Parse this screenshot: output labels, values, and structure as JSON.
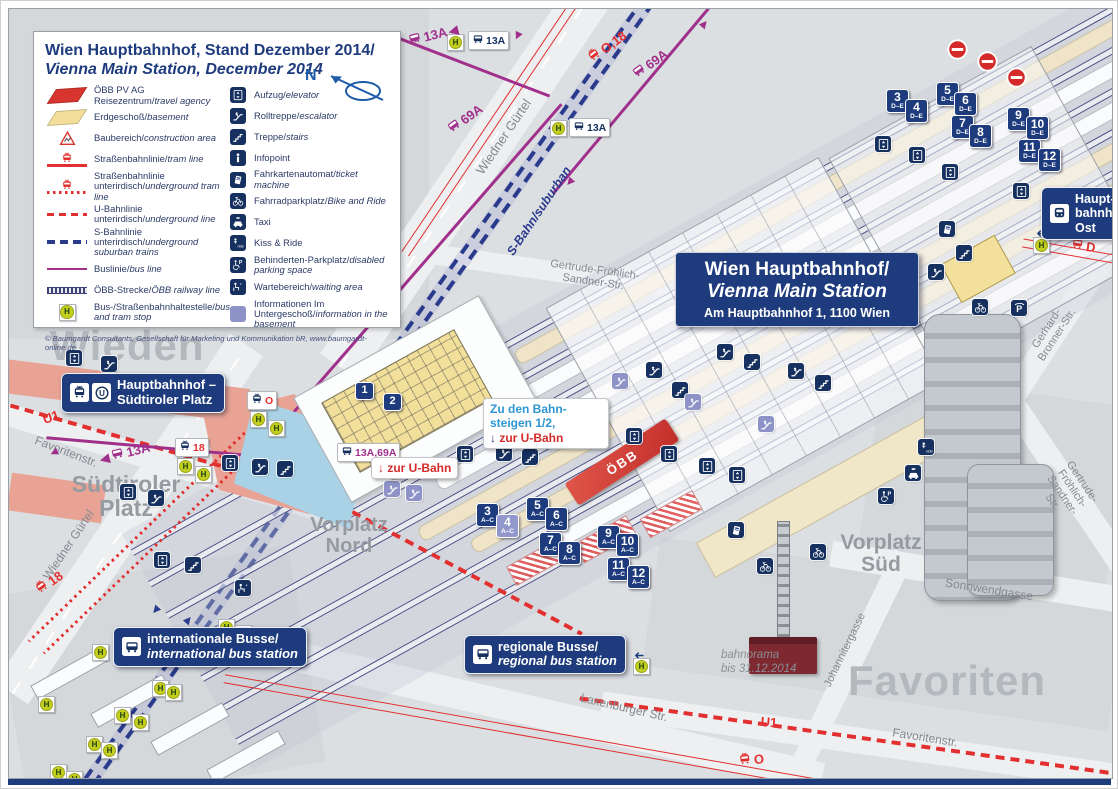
{
  "legend": {
    "title_de": "Wien Hauptbahnhof, Stand Dezember 2014/",
    "title_en": "Vienna Main Station, December 2014",
    "copyright": "© Baumgardt Consultants, Gesellschaft für Marketing und Kommunikation bR, www.baumgardt-online.de",
    "north_label": "N",
    "left_items": [
      {
        "icon": "sw-red",
        "de": "ÖBB PV AG Reisezentrum/",
        "en": "travel agency"
      },
      {
        "icon": "sw-yellow",
        "de": "Erdgeschoß/",
        "en": "basement"
      },
      {
        "icon": "construction",
        "de": "Baubereich/",
        "en": "construction area"
      },
      {
        "icon": "line-tram",
        "de": "Straßenbahnlinie/",
        "en": "tram line"
      },
      {
        "icon": "line-tram-ug",
        "de": "Straßenbahnlinie unterirdisch/",
        "en": "underground tram line"
      },
      {
        "icon": "line-u",
        "de": "U-Bahnlinie unterirdisch/",
        "en": "underground line"
      },
      {
        "icon": "line-s",
        "de": "S-Bahnlinie unterirdisch/",
        "en": "underground suburban trains"
      },
      {
        "icon": "line-bus",
        "de": "Buslinie/",
        "en": "bus line"
      },
      {
        "icon": "line-rail",
        "de": "ÖBB-Strecke/",
        "en": "ÖBB railway line"
      },
      {
        "icon": "hstop",
        "de": "Bus-/Straßenbahnhaltestelle/",
        "en": "bus and tram stop"
      }
    ],
    "right_items": [
      {
        "icon": "elevator",
        "de": "Aufzug/",
        "en": "elevator"
      },
      {
        "icon": "escalator",
        "de": "Rolltreppe/",
        "en": "escalator"
      },
      {
        "icon": "stairs",
        "de": "Treppe/",
        "en": "stairs"
      },
      {
        "icon": "info",
        "de": "Infopoint",
        "en": ""
      },
      {
        "icon": "ticket",
        "de": "Fahrkartenautomat/",
        "en": "ticket machine"
      },
      {
        "icon": "bike",
        "de": "Fahrradparkplatz/",
        "en": "Bike and Ride"
      },
      {
        "icon": "taxi",
        "de": "Taxi",
        "en": ""
      },
      {
        "icon": "kissride",
        "de": "Kiss & Ride",
        "en": ""
      },
      {
        "icon": "disabled",
        "de": "Behinderten-Parkplatz/",
        "en": "disabled parking space"
      },
      {
        "icon": "waiting",
        "de": "Wartebereich/",
        "en": "waiting area"
      },
      {
        "icon": "basement",
        "de": "Informationen Im Untergeschoß/",
        "en": "information in the basement"
      }
    ]
  },
  "title_box": {
    "line1": "Wien Hauptbahnhof/",
    "line2": "Vienna Main Station",
    "line3": "Am Hauptbahnhof 1, 1100 Wien"
  },
  "badges": {
    "hbf_suedtiroler": {
      "line1": "Hauptbahnhof –",
      "line2": "Südtiroler Platz"
    },
    "hbf_ost": {
      "line1": "Haupt-",
      "line2": "bahnhof",
      "line3": "Ost"
    },
    "int_bus": {
      "line1": "internationale Busse/",
      "line2": "international bus station"
    },
    "reg_bus": {
      "line1": "regionale Busse/",
      "line2": "regional bus station"
    }
  },
  "info_boxes": {
    "platforms": {
      "line1": "Zu den Bahn-",
      "line2": "steigen 1/2,",
      "arrow": "↓",
      "line3": "zur U-Bahn"
    },
    "ubahn": {
      "arrow": "↓",
      "text": "zur U-Bahn"
    }
  },
  "oebb_band_label": "ÖBB",
  "bahnorama": {
    "line1": "bahnorama",
    "line2": "bis 31.12.2014"
  },
  "icon_letters": {
    "ubahn": "U",
    "hstop": "H",
    "parking": "P"
  },
  "districts": [
    {
      "text": "Wieden",
      "x": 118,
      "y": 337,
      "size": 42
    },
    {
      "text": "Favoriten",
      "x": 938,
      "y": 672,
      "size": 42
    }
  ],
  "places": [
    {
      "lines": [
        "Südtiroler",
        "Platz"
      ],
      "x": 117,
      "y": 487,
      "size": 23
    },
    {
      "lines": [
        "Vorplatz",
        "Nord"
      ],
      "x": 340,
      "y": 527,
      "size": 20
    },
    {
      "lines": [
        "Vorplatz",
        "Süd"
      ],
      "x": 872,
      "y": 545,
      "size": 21
    }
  ],
  "streets": [
    {
      "text": "Wiedner Gürtel",
      "x": 495,
      "y": 128,
      "rot": -56,
      "size": 13
    },
    {
      "text": "Wiedner Gürtel",
      "x": 60,
      "y": 536,
      "rot": -56,
      "size": 12
    },
    {
      "text": "Favoritenstr.",
      "x": 57,
      "y": 443,
      "rot": 21,
      "size": 12
    },
    {
      "text": "Favoritenstr.",
      "x": 916,
      "y": 729,
      "rot": 9,
      "size": 12
    },
    {
      "text": "Gertrude-Fröhlich-\nSandner-Str.",
      "x": 585,
      "y": 267,
      "rot": 8,
      "size": 11
    },
    {
      "text": "Gertrude-Fröhlich-Sandner-Str.",
      "x": 1058,
      "y": 483,
      "rot": 56,
      "size": 11
    },
    {
      "text": "Gerhard-Bronner-Str.",
      "x": 1043,
      "y": 323,
      "rot": -57,
      "size": 11
    },
    {
      "text": "Sonnwendgasse",
      "x": 980,
      "y": 581,
      "rot": 9,
      "size": 12
    },
    {
      "text": "Johannitergasse",
      "x": 836,
      "y": 641,
      "rot": -64,
      "size": 11
    },
    {
      "text": "Laxenburger Str.",
      "x": 615,
      "y": 699,
      "rot": 13,
      "size": 12
    }
  ],
  "line_labels": [
    {
      "text": "13A",
      "x": 424,
      "y": 26,
      "rot": -14,
      "color": "#a0308c",
      "icon": "bus",
      "arrow": "trail"
    },
    {
      "text": "O,18",
      "x": 598,
      "y": 38,
      "rot": -36,
      "color": "#e23030",
      "icon": "tram"
    },
    {
      "text": "69A",
      "x": 641,
      "y": 55,
      "rot": -36,
      "color": "#a0308c",
      "icon": "bus"
    },
    {
      "text": "69A",
      "x": 456,
      "y": 110,
      "rot": -36,
      "color": "#a0308c",
      "icon": "bus"
    },
    {
      "text": "13A",
      "x": 116,
      "y": 444,
      "rot": -14,
      "color": "#a0308c",
      "icon": "bus",
      "arrow": "lead"
    },
    {
      "text": "U1",
      "x": 42,
      "y": 408,
      "rot": -20,
      "color": "#e23030"
    },
    {
      "text": "18",
      "x": 40,
      "y": 574,
      "rot": -36,
      "color": "#e23030",
      "icon": "tram"
    },
    {
      "text": "S-Bahn/suburban",
      "x": 530,
      "y": 202,
      "rot": -56,
      "color": "#2a3a8c",
      "italic": true,
      "size": 12.5
    },
    {
      "text": "D",
      "x": 1074,
      "y": 237,
      "rot": 8,
      "color": "#e23030",
      "icon": "tram"
    },
    {
      "text": "U1",
      "x": 760,
      "y": 713,
      "rot": 5,
      "color": "#e23030"
    },
    {
      "text": "O",
      "x": 742,
      "y": 751,
      "rot": -6,
      "color": "#e23030",
      "icon": "tram"
    }
  ],
  "stop_badges": [
    {
      "icon": "bus",
      "text": "13A",
      "x": 459,
      "y": 22,
      "color": "#16315f"
    },
    {
      "icon": "bus",
      "text": "13A",
      "x": 560,
      "y": 109,
      "color": "#16315f"
    },
    {
      "icon": "bus",
      "text": "13A,69A",
      "x": 328,
      "y": 434,
      "color": "#a0308c"
    },
    {
      "icon": "tram",
      "text": "18",
      "x": 166,
      "y": 429,
      "color": "#e23030"
    },
    {
      "icon": "tram",
      "text": "O",
      "x": 238,
      "y": 382,
      "color": "#e23030"
    }
  ],
  "platform_badges": [
    {
      "n": "1",
      "x": 346,
      "y": 373,
      "plain": true
    },
    {
      "n": "2",
      "x": 374,
      "y": 384,
      "plain": true
    },
    {
      "n": "3",
      "l": "A–C",
      "x": 467,
      "y": 494
    },
    {
      "n": "4",
      "l": "A–C",
      "x": 487,
      "y": 505,
      "light": true
    },
    {
      "n": "5",
      "l": "A–C",
      "x": 517,
      "y": 488
    },
    {
      "n": "6",
      "l": "A–C",
      "x": 536,
      "y": 498
    },
    {
      "n": "7",
      "l": "A–C",
      "x": 530,
      "y": 523
    },
    {
      "n": "8",
      "l": "A–C",
      "x": 549,
      "y": 532
    },
    {
      "n": "9",
      "l": "A–C",
      "x": 588,
      "y": 516
    },
    {
      "n": "10",
      "l": "A–C",
      "x": 607,
      "y": 524
    },
    {
      "n": "11",
      "l": "A–C",
      "x": 598,
      "y": 548
    },
    {
      "n": "12",
      "l": "A–C",
      "x": 618,
      "y": 556
    },
    {
      "n": "3",
      "l": "D–E",
      "x": 877,
      "y": 80
    },
    {
      "n": "4",
      "l": "D–E",
      "x": 896,
      "y": 90
    },
    {
      "n": "5",
      "l": "D–E",
      "x": 927,
      "y": 73
    },
    {
      "n": "6",
      "l": "D–E",
      "x": 945,
      "y": 83
    },
    {
      "n": "7",
      "l": "D–E",
      "x": 942,
      "y": 106
    },
    {
      "n": "8",
      "l": "D–E",
      "x": 960,
      "y": 115
    },
    {
      "n": "9",
      "l": "D–E",
      "x": 998,
      "y": 98
    },
    {
      "n": "10",
      "l": "D–E",
      "x": 1017,
      "y": 107
    },
    {
      "n": "11",
      "l": "D–E",
      "x": 1009,
      "y": 130
    },
    {
      "n": "12",
      "l": "D–E",
      "x": 1029,
      "y": 139
    }
  ],
  "icons": [
    {
      "t": "elevator",
      "x": 57,
      "y": 341
    },
    {
      "t": "escalator",
      "x": 92,
      "y": 347
    },
    {
      "t": "elevator",
      "x": 111,
      "y": 475
    },
    {
      "t": "escalator",
      "x": 139,
      "y": 481
    },
    {
      "t": "elevator",
      "x": 213,
      "y": 446
    },
    {
      "t": "escalator",
      "x": 243,
      "y": 450
    },
    {
      "t": "stairs",
      "x": 268,
      "y": 452
    },
    {
      "t": "elevator",
      "x": 145,
      "y": 543
    },
    {
      "t": "stairs",
      "x": 176,
      "y": 548
    },
    {
      "t": "elevator",
      "x": 448,
      "y": 437
    },
    {
      "t": "escalator",
      "x": 487,
      "y": 436
    },
    {
      "t": "stairs",
      "x": 513,
      "y": 440
    },
    {
      "t": "escalator",
      "x": 375,
      "y": 472,
      "light": true
    },
    {
      "t": "escalator",
      "x": 397,
      "y": 476,
      "light": true
    },
    {
      "t": "elevator",
      "x": 617,
      "y": 419
    },
    {
      "t": "elevator",
      "x": 652,
      "y": 437
    },
    {
      "t": "elevator",
      "x": 690,
      "y": 449
    },
    {
      "t": "elevator",
      "x": 720,
      "y": 458
    },
    {
      "t": "escalator",
      "x": 637,
      "y": 353
    },
    {
      "t": "stairs",
      "x": 663,
      "y": 373
    },
    {
      "t": "escalator",
      "x": 708,
      "y": 335
    },
    {
      "t": "stairs",
      "x": 735,
      "y": 345
    },
    {
      "t": "escalator",
      "x": 779,
      "y": 354
    },
    {
      "t": "stairs",
      "x": 806,
      "y": 366
    },
    {
      "t": "escalator",
      "x": 849,
      "y": 297
    },
    {
      "t": "stairs",
      "x": 876,
      "y": 278
    },
    {
      "t": "escalator",
      "x": 919,
      "y": 255
    },
    {
      "t": "stairs",
      "x": 947,
      "y": 236
    },
    {
      "t": "escalator",
      "x": 603,
      "y": 364,
      "light": true
    },
    {
      "t": "escalator",
      "x": 676,
      "y": 385,
      "light": true
    },
    {
      "t": "escalator",
      "x": 749,
      "y": 407,
      "light": true
    },
    {
      "t": "elevator",
      "x": 866,
      "y": 127
    },
    {
      "t": "elevator",
      "x": 900,
      "y": 138
    },
    {
      "t": "elevator",
      "x": 933,
      "y": 155
    },
    {
      "t": "elevator",
      "x": 1004,
      "y": 174
    },
    {
      "t": "waiting",
      "x": 226,
      "y": 571
    },
    {
      "t": "ticket",
      "x": 719,
      "y": 513
    },
    {
      "t": "ticket",
      "x": 930,
      "y": 212
    },
    {
      "t": "bike",
      "x": 963,
      "y": 290
    },
    {
      "t": "bike",
      "x": 748,
      "y": 549
    },
    {
      "t": "bike",
      "x": 801,
      "y": 535
    },
    {
      "t": "parking",
      "x": 1002,
      "y": 291
    },
    {
      "t": "kissride",
      "x": 909,
      "y": 430
    },
    {
      "t": "taxi",
      "x": 896,
      "y": 456
    },
    {
      "t": "disabled",
      "x": 869,
      "y": 479
    },
    {
      "t": "arrowL",
      "x": 622,
      "y": 638
    },
    {
      "t": "arrowL",
      "x": 1024,
      "y": 216
    },
    {
      "t": "parrow",
      "x": 36,
      "y": 436,
      "rot": -115
    },
    {
      "t": "parrow",
      "x": 396,
      "y": 20,
      "rot": -65
    },
    {
      "t": "parrow",
      "x": 688,
      "y": 6,
      "rot": 40
    },
    {
      "t": "parrow",
      "x": 552,
      "y": 166,
      "rot": 220
    },
    {
      "t": "parrow",
      "x": 500,
      "y": 20,
      "rot": 205
    },
    {
      "t": "sarrow",
      "x": 138,
      "y": 594,
      "rot": 220
    },
    {
      "t": "sarrow",
      "x": 172,
      "y": 602,
      "rot": 40
    }
  ],
  "h_stops": [
    {
      "x": 438,
      "y": 25
    },
    {
      "x": 541,
      "y": 111
    },
    {
      "x": 1024,
      "y": 228
    },
    {
      "x": 241,
      "y": 402
    },
    {
      "x": 259,
      "y": 411
    },
    {
      "x": 168,
      "y": 449
    },
    {
      "x": 186,
      "y": 457
    },
    {
      "x": 624,
      "y": 649
    },
    {
      "x": 209,
      "y": 610
    },
    {
      "x": 226,
      "y": 616
    },
    {
      "x": 83,
      "y": 635
    },
    {
      "x": 143,
      "y": 671
    },
    {
      "x": 156,
      "y": 675
    },
    {
      "x": 29,
      "y": 687
    },
    {
      "x": 105,
      "y": 698
    },
    {
      "x": 123,
      "y": 705
    },
    {
      "x": 77,
      "y": 727
    },
    {
      "x": 92,
      "y": 733
    },
    {
      "x": 41,
      "y": 755
    },
    {
      "x": 57,
      "y": 762
    }
  ],
  "no_entry": [
    {
      "x": 938,
      "y": 30
    },
    {
      "x": 968,
      "y": 42
    },
    {
      "x": 997,
      "y": 58
    }
  ],
  "colors": {
    "navy": "#1e3c7d",
    "red": "#e23030",
    "bus_purple": "#a0308c",
    "sbahn_blue": "#2a3a8c",
    "hstop_green": "#c3cf1f",
    "salmon": "#e8a395",
    "plaza_blue": "#a9d2e6"
  }
}
